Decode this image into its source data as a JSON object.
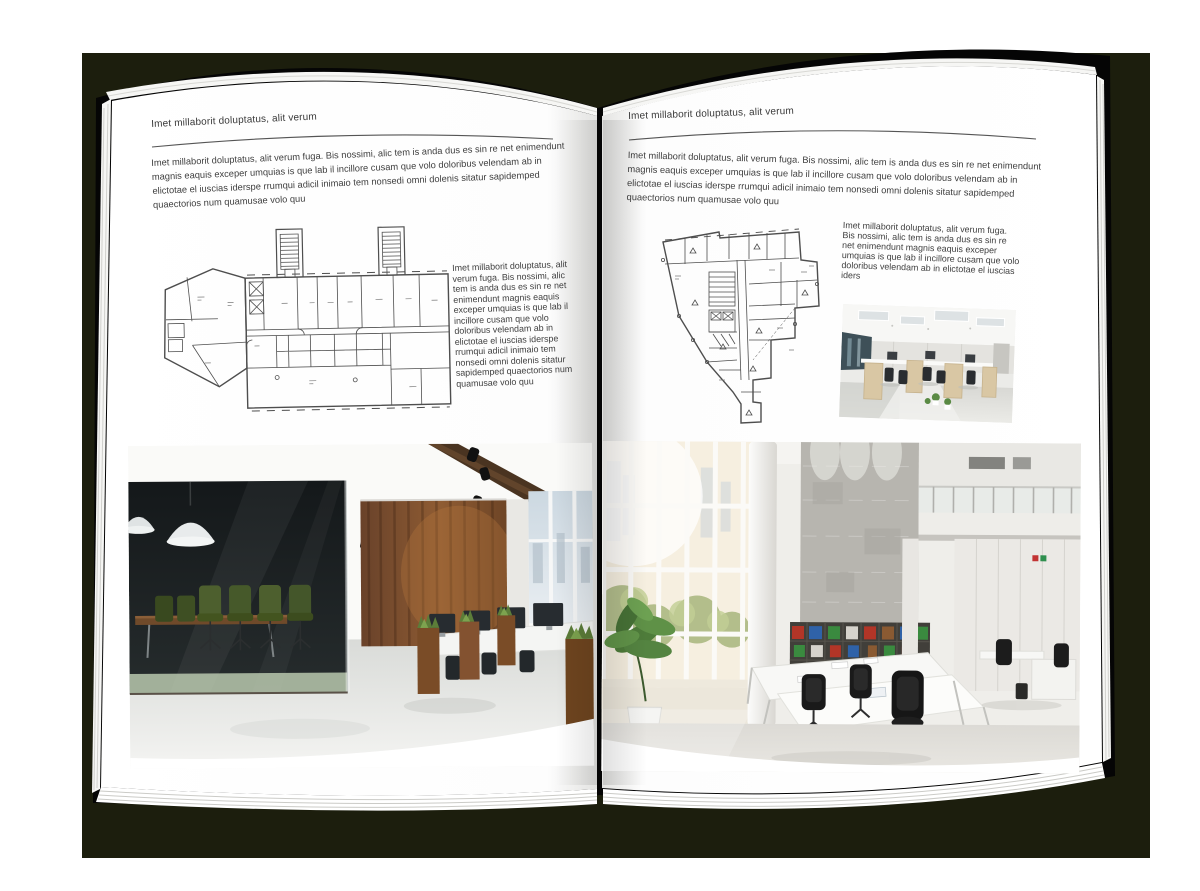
{
  "document": {
    "type": "interior-design brochure spread (open magazine mockup)",
    "colors": {
      "backdrop": "#1c1e0d",
      "cover": "#050505",
      "page": "#ffffff",
      "text": "#3e3e3e",
      "rule": "#555555"
    }
  },
  "left_page": {
    "header": "Imet millaborit doluptatus, alit verum",
    "intro": "Imet millaborit doluptatus, alit verum fuga. Bis nossimi, alic tem is anda dus es sin re net enimendunt magnis eaquis exceper umquias is que lab il incillore cusam que volo doloribus velendam ab in elictotae el iuscias iderspe rrumqui adicil inimaio tem nonsedi omni dolenis sitatur sapidemped quaectorios num quamusae volo quu",
    "side_text": "Imet millaborit doluptatus, alit verum fuga. Bis nossimi, alic tem is anda dus es sin re net enimendunt magnis eaquis exceper umquias is que lab il incillore cusam que volo doloribus velendam ab in elictotae el iuscias iderspe rrumqui adicil inimaio tem nonsedi omni dolenis sitatur sapidemped quaectorios num quamusae volo quu",
    "figures": {
      "floorplan": "architectural-floor-plan-elongated-wing",
      "photo": "office-interior-dark-glass-meeting-room-wood-wall"
    }
  },
  "right_page": {
    "header": "Imet millaborit doluptatus, alit verum",
    "intro": "Imet millaborit doluptatus, alit verum fuga. Bis nossimi, alic tem is anda dus es sin re net enimendunt magnis eaquis exceper umquias is que lab il incillore cusam que volo doloribus velendam ab in elictotae el iuscias iderspe rrumqui adicil inimaio tem nonsedi omni dolenis sitatur sapidemped quaectorios num quamusae volo quu",
    "side_text": "Imet millaborit doluptatus, alit verum fuga. Bis nossimi, alic tem is anda dus es sin re net enimendunt magnis eaquis exceper umquias is que lab il incillore cusam que volo doloribus velendam ab in elictotae el iuscias iders",
    "figures": {
      "floorplan": "architectural-floor-plan-irregular-footprint",
      "photo_small": "open-plan-office-workstations",
      "photo_large": "double-height-bright-office-atrium"
    }
  }
}
